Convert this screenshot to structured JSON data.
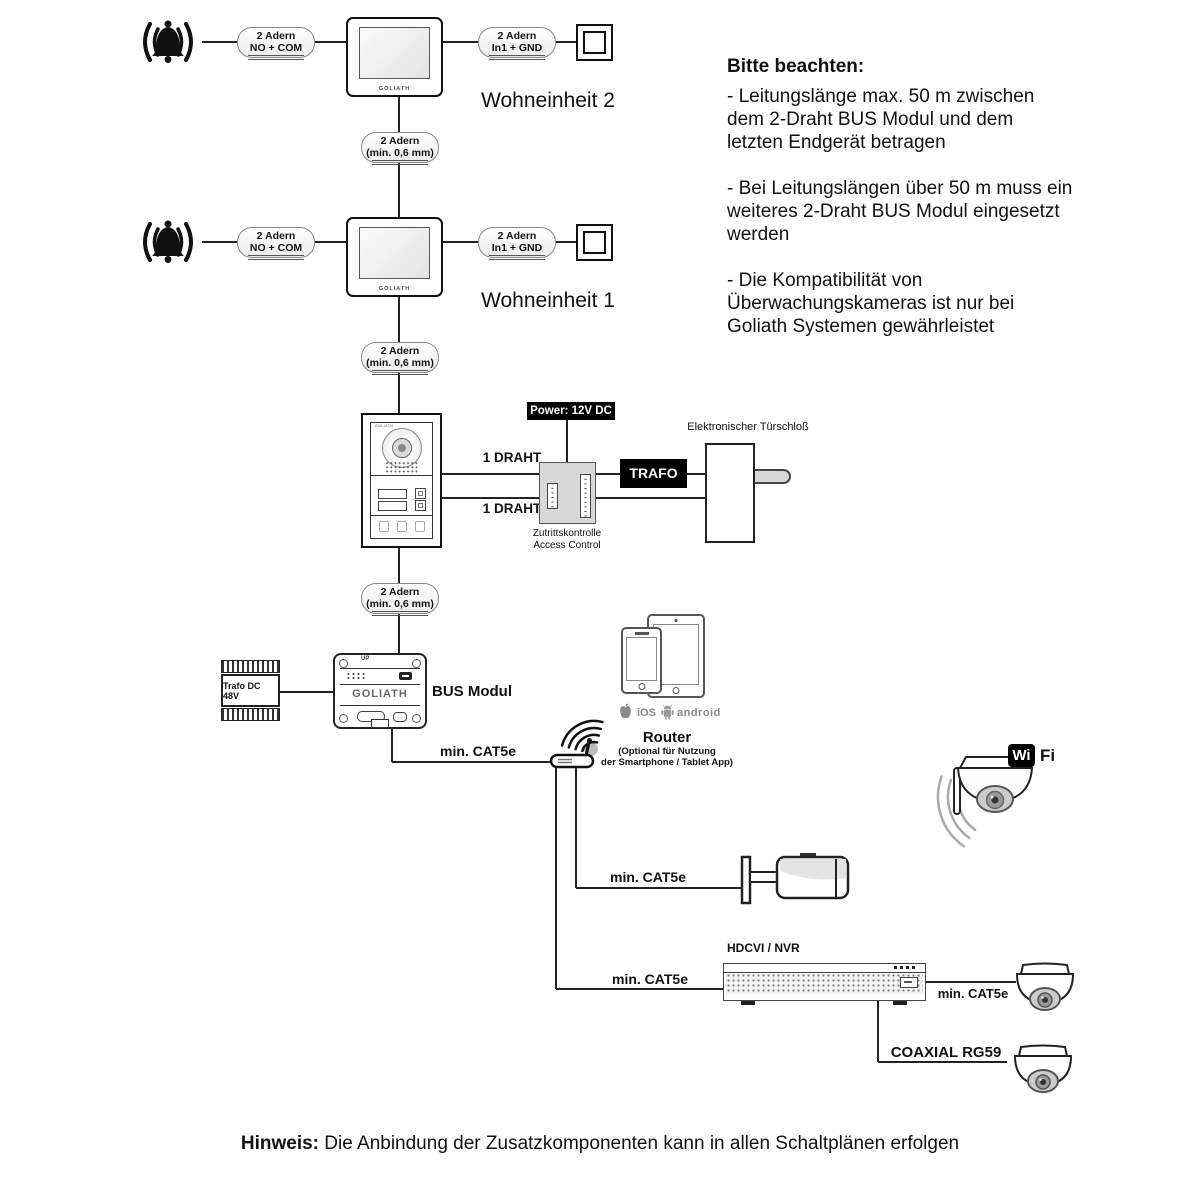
{
  "pills": {
    "no_com": {
      "l1": "2 Adern",
      "l2": "NO + COM"
    },
    "in1_gnd": {
      "l1": "2 Adern",
      "l2": "In1 + GND"
    },
    "min06": {
      "l1": "2 Adern",
      "l2": "(min. 0,6 mm)"
    }
  },
  "units": {
    "unit2": "Wohneinheit 2",
    "unit1": "Wohneinheit 1"
  },
  "notes": {
    "title": "Bitte beachten:",
    "items": [
      "- Leitungslänge max. 50 m zwischen\ndem 2-Draht BUS Modul und dem\nletzten Endgerät betragen",
      "- Bei Leitungslängen über 50 m muss ein\nweiteres 2-Draht BUS Modul eingesetzt\nwerden",
      "- Die Kompatibilität von\nÜberwachungskameras ist nur bei\nGoliath Systemen gewährleistet"
    ]
  },
  "labels": {
    "power": "Power: 12V DC",
    "draht": "1 DRAHT",
    "trafo": "TRAFO",
    "lock": "Elektronischer Türschloß",
    "access_de": "Zutrittskontrolle",
    "access_en": "Access Control",
    "trafo48": "Trafo DC 48V",
    "bus": "BUS Modul",
    "brand": "GOLIATH",
    "up": "UP",
    "cat5e": "min. CAT5e",
    "coax": "COAXIAL RG59",
    "nvr": "HDCVI / NVR",
    "wi": "Wi",
    "fi": "Fi",
    "ios": "iOS",
    "android": "android",
    "router_title": "Router",
    "router_sub1": "(Optional für Nutzung",
    "router_sub2": "der Smartphone / Tablet App)"
  },
  "hinweis": {
    "bold": "Hinweis:",
    "text": " Die Anbindung der Zusatzkomponenten kann in allen Schaltplänen erfolgen"
  },
  "colors": {
    "line": "#222",
    "device_gray": "#d8d8d8",
    "lens_gray": "#cccccc",
    "black": "#000000"
  }
}
